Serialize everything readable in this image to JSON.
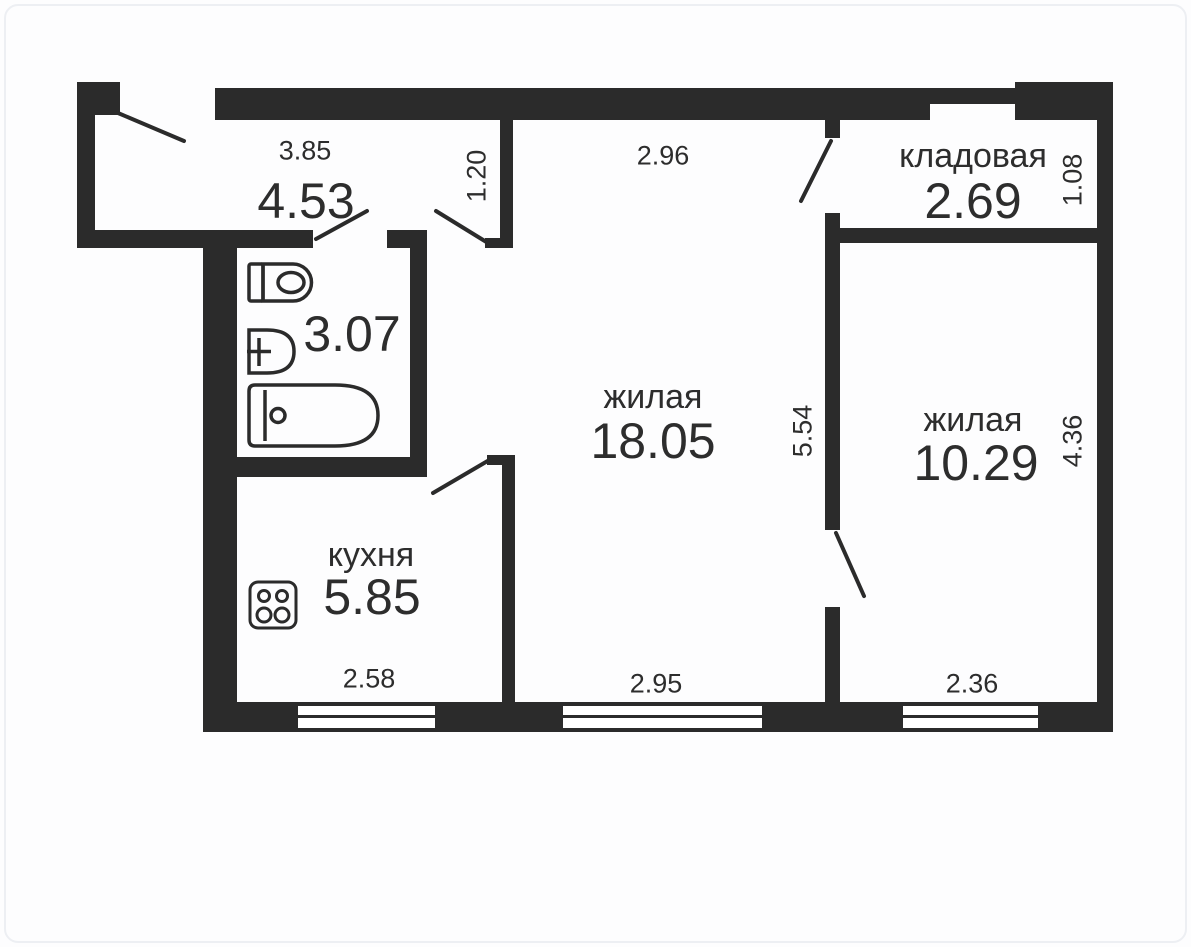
{
  "plan": {
    "title": "apartment-floor-plan",
    "colors": {
      "wall": "#2b2b2b",
      "text": "#2d2d2d",
      "background": "#fdfdfe"
    },
    "rooms": {
      "hallway": {
        "area": "4.53",
        "width": "3.85",
        "depth": "1.20"
      },
      "bathroom": {
        "area": "3.07"
      },
      "kitchen": {
        "name": "кухня",
        "area": "5.85",
        "width": "2.58"
      },
      "living_main": {
        "name": "жилая",
        "area": "18.05",
        "width_top": "2.96",
        "width_bottom": "2.95",
        "depth": "5.54"
      },
      "storage": {
        "name": "кладовая",
        "area": "2.69",
        "depth": "1.08"
      },
      "living_second": {
        "name": "жилая",
        "area": "10.29",
        "width_bottom": "2.36",
        "depth": "4.36"
      }
    },
    "fixtures": [
      "toilet",
      "sink",
      "bathtub",
      "stove"
    ],
    "window_count": 3,
    "door_count": 6
  }
}
